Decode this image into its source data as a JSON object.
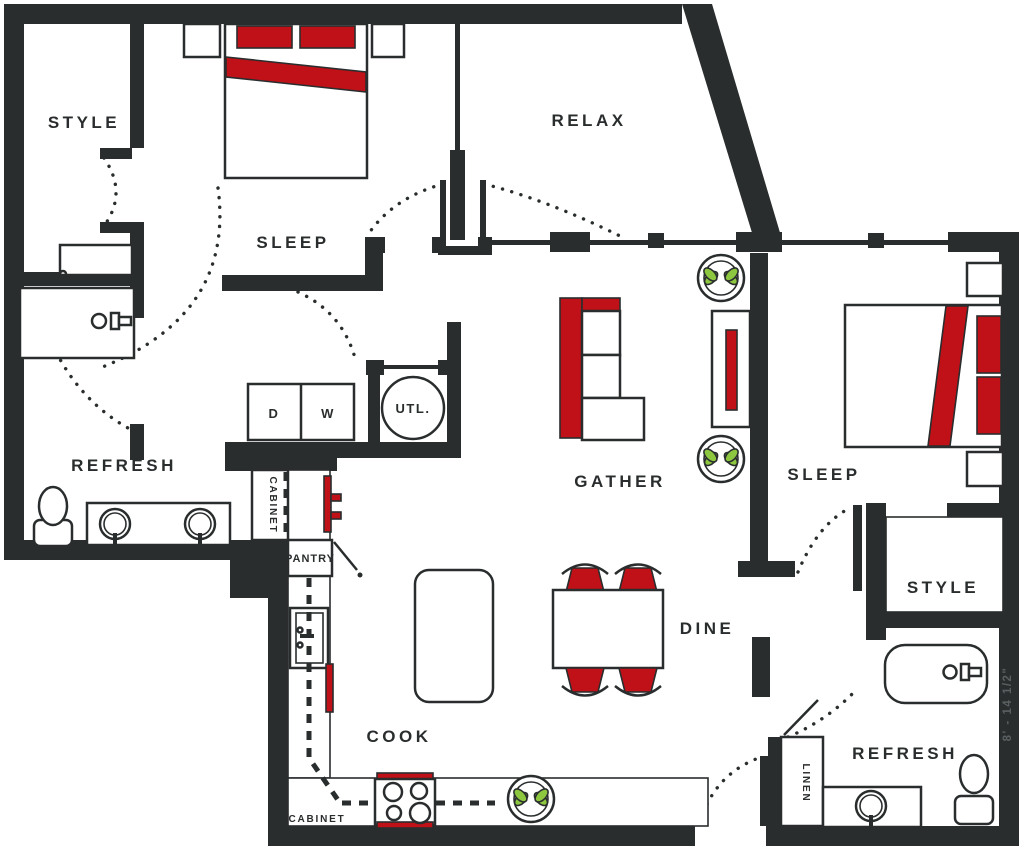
{
  "colors": {
    "wall": "#2a2d2e",
    "accent_red": "#bf1117",
    "plant_green": "#8dc63f",
    "dimension_text": "#5a6062",
    "background": "#ffffff"
  },
  "labels": {
    "style1": "STYLE",
    "sleep1": "SLEEP",
    "relax": "RELAX",
    "refresh1": "REFRESH",
    "gather": "GATHER",
    "sleep2": "SLEEP",
    "style2": "STYLE",
    "dine": "DINE",
    "cook": "COOK",
    "refresh2": "REFRESH",
    "dryer": "D",
    "washer": "W",
    "utility": "UTL.",
    "pantry": "PANTRY",
    "cabinet_top": "CABINET",
    "cabinet_bottom": "CABINET",
    "linen": "LINEN",
    "dimension_right": "8' - 14 1/2\""
  }
}
